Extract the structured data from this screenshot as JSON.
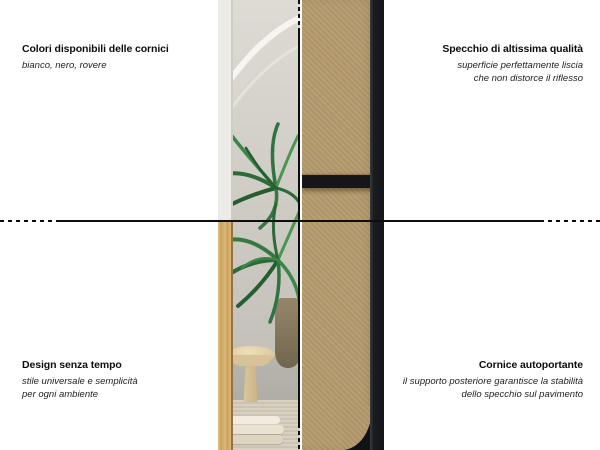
{
  "annotations": {
    "top_left": {
      "title": "Colori disponibili delle cornici",
      "subtitle_lines": [
        "bianco, nero, rovere"
      ]
    },
    "top_right": {
      "title": "Specchio di altissima qualità",
      "subtitle_lines": [
        "superficie perfettamente liscia",
        "che non distorce il riflesso"
      ]
    },
    "bottom_left": {
      "title": "Design senza tempo",
      "subtitle_lines": [
        "stile universale e semplicità",
        "per ogni ambiente"
      ]
    },
    "bottom_right": {
      "title": "Cornice autoportante",
      "subtitle_lines": [
        "il supporto posteriore garantisce la stabilità",
        "dello specchio sul pavimento"
      ]
    }
  },
  "colors": {
    "background": "#ffffff",
    "guide_line": "#0d0d0d",
    "frame_black": "#141619",
    "mdf_brown": "#b49a6e",
    "oak_rovere": "#d0aa68",
    "frame_white": "#ecebe8",
    "plant_green": "#35793f"
  }
}
